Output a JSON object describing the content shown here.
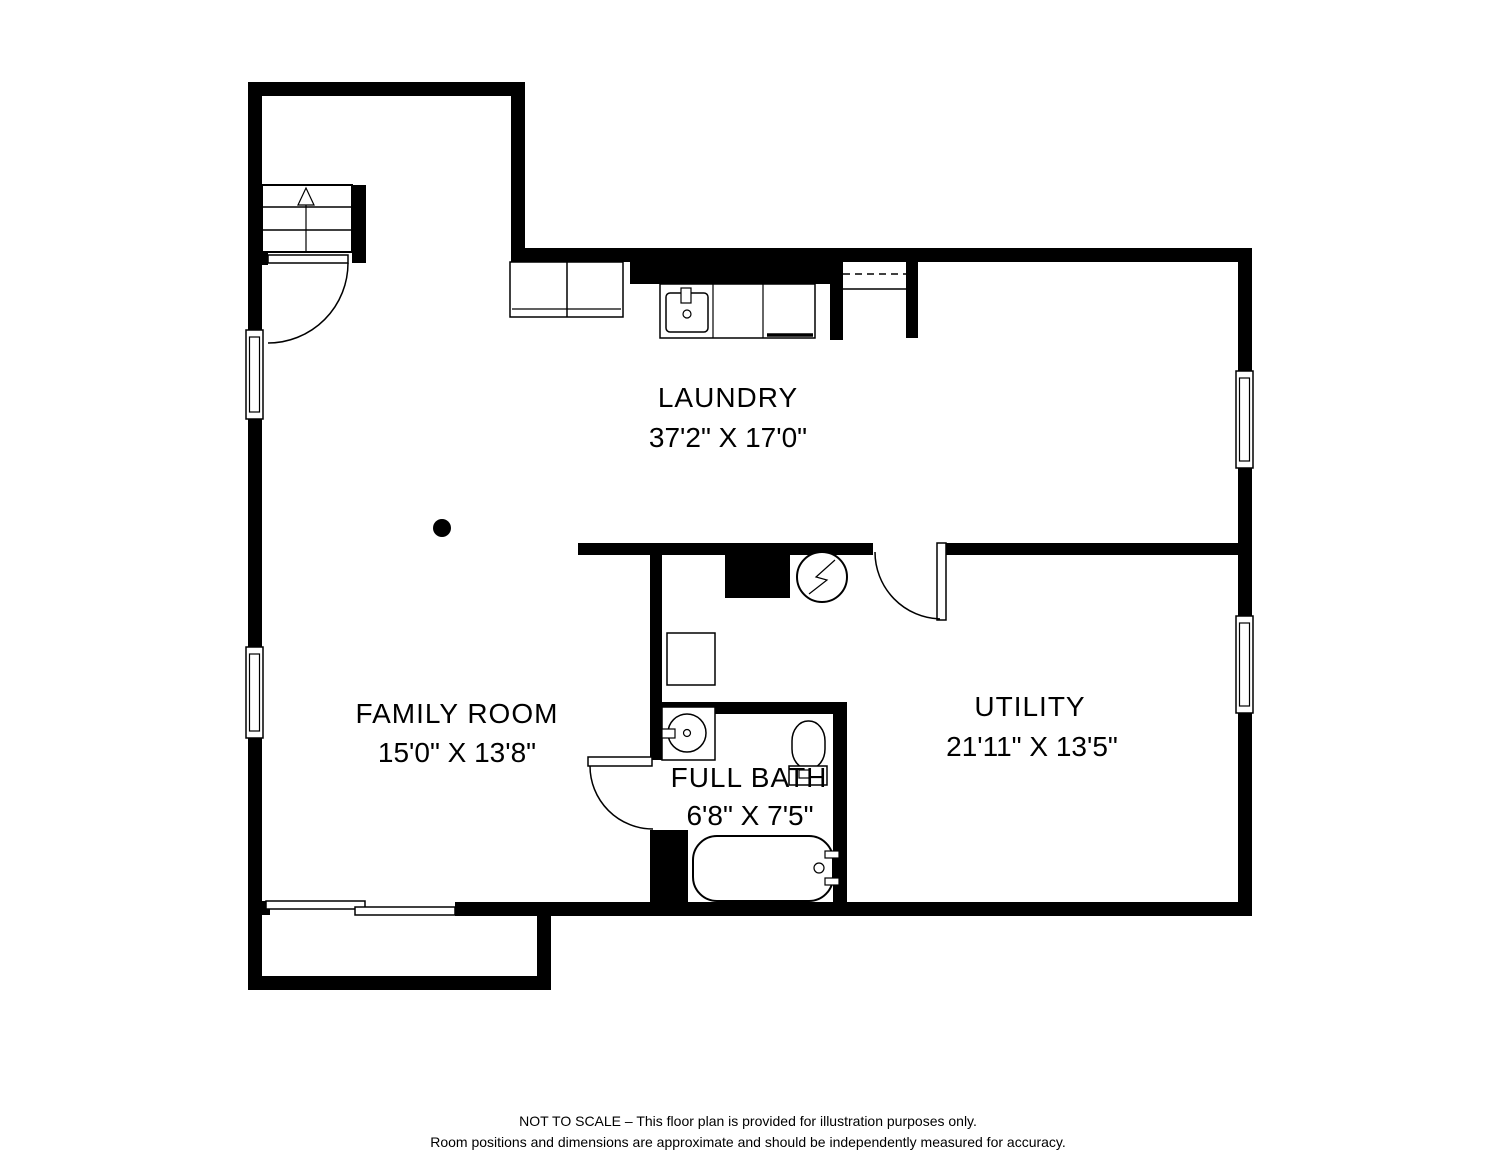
{
  "plan": {
    "rooms": [
      {
        "id": "laundry",
        "name": "LAUNDRY",
        "dims": "37'2\" X 17'0\""
      },
      {
        "id": "family-room",
        "name": "FAMILY ROOM",
        "dims": "15'0\" X 13'8\""
      },
      {
        "id": "utility",
        "name": "UTILITY",
        "dims": "21'11\" X 13'5\""
      },
      {
        "id": "full-bath",
        "name": "FULL BATH",
        "dims": "6'8\" X 7'5\""
      }
    ],
    "fixtures": [
      "stairs-up-arrow",
      "entry-door-swing",
      "washer-dryer",
      "laundry-sink-counter",
      "dishwasher",
      "closet-shelf-dashed",
      "support-column",
      "chimney-block",
      "water-heater-electric",
      "furnace",
      "utility-door-swing",
      "bath-door-swing",
      "vanity-round-sink",
      "toilet",
      "bathtub",
      "sliding-patio-door",
      "window-left-upper",
      "window-left-lower",
      "window-right-upper",
      "window-right-lower"
    ],
    "disclaimer": [
      "NOT TO SCALE – This floor plan is provided for illustration purposes only.",
      "Room positions and dimensions are approximate and should be independently measured for accuracy."
    ],
    "colors": {
      "walls": "#000000",
      "lines": "#000000",
      "background": "#ffffff"
    }
  }
}
